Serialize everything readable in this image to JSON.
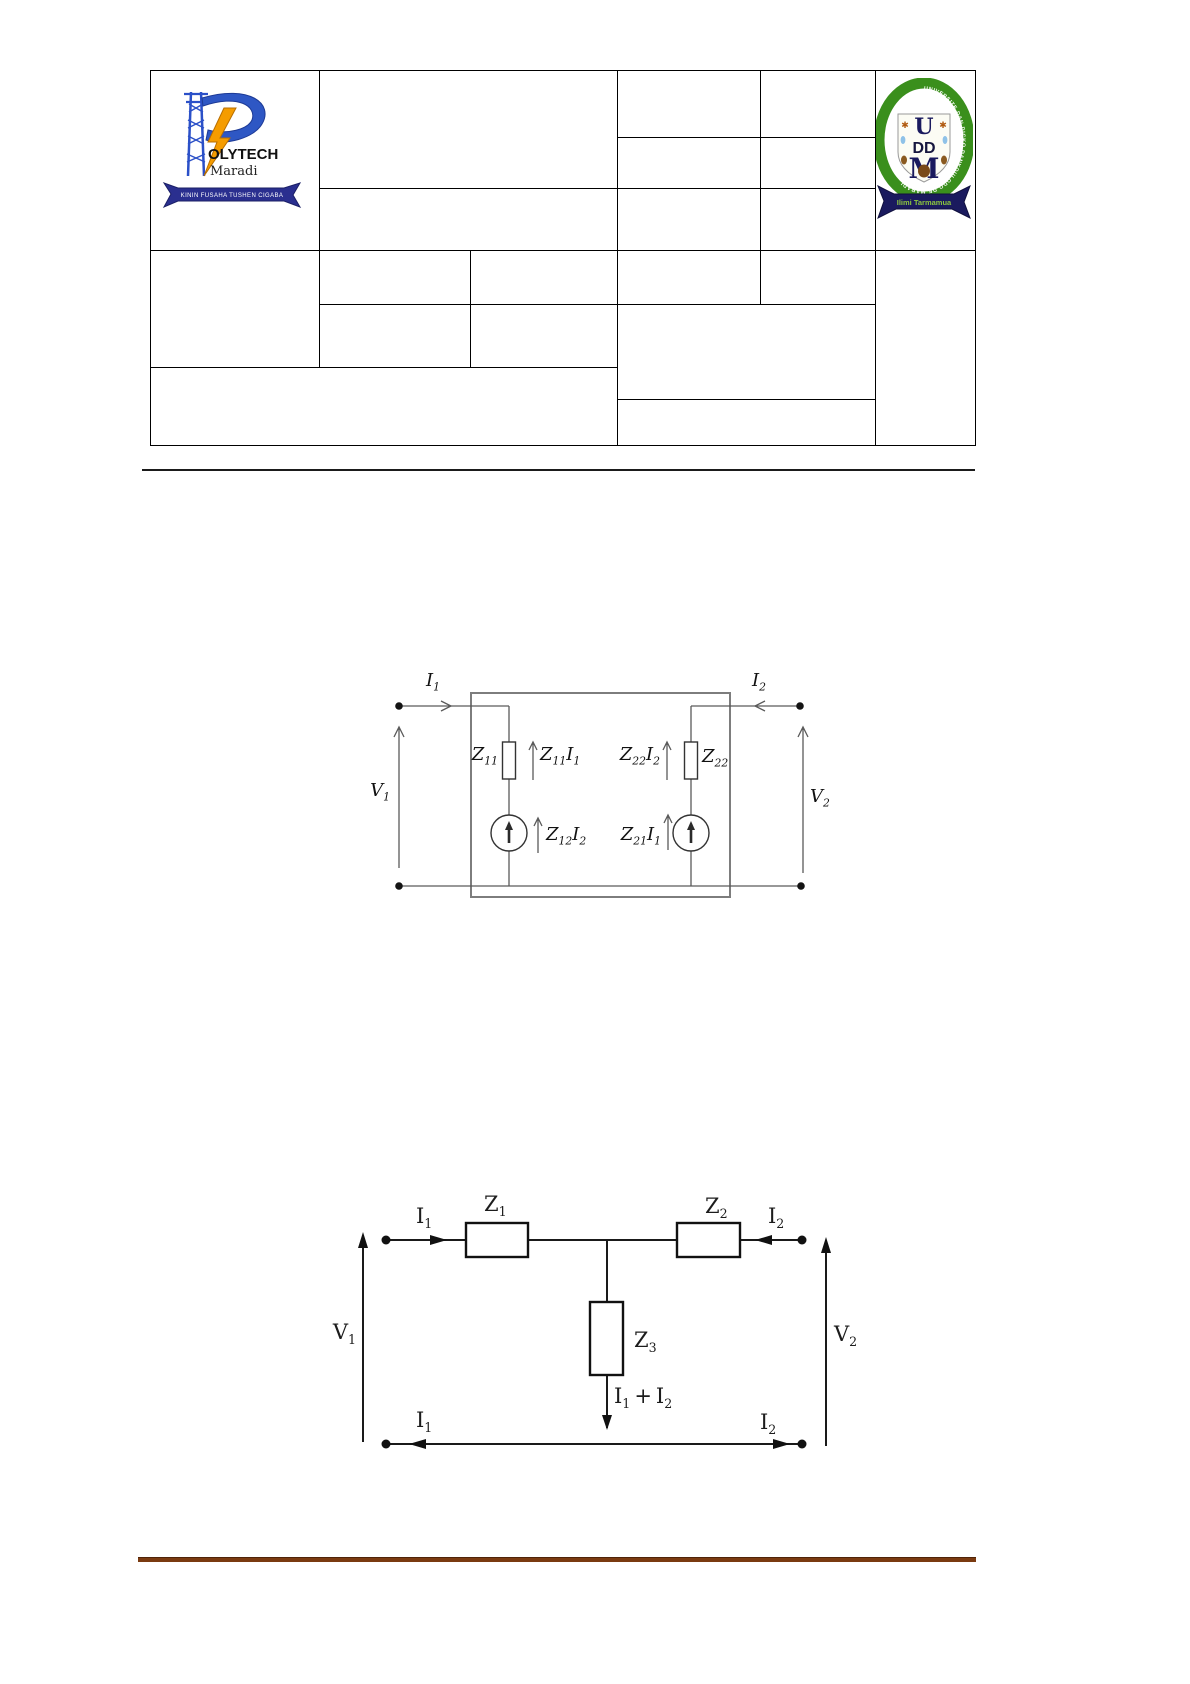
{
  "document": {
    "background": "#ffffff"
  },
  "header": {
    "polytech_logo": {
      "initial": "P",
      "wordmark": "OLYTECH",
      "city": "Maradi",
      "motto": "KININ FUSAHA TUSHEN CIGABA",
      "blue": "#2b50c8",
      "orange": "#f59c00",
      "ribbon_navy": "#2a2f8f"
    },
    "uddm_logo": {
      "ring_text": "UNIVERSITE DAN DICKO DANKOULODO DE MARADI",
      "monogram_u": "U",
      "monogram_dd": "DD",
      "monogram_m": "M",
      "ribbon_text": "Ilimi Tarmamua",
      "green": "#3a8f1c",
      "navy": "#1a1a5e",
      "ribbon_text_color": "#8cc63f"
    }
  },
  "figure1": {
    "i1": {
      "b": "I",
      "s": "1"
    },
    "i2": {
      "b": "I",
      "s": "2"
    },
    "v1": {
      "b": "V",
      "s": "1"
    },
    "v2": {
      "b": "V",
      "s": "2"
    },
    "z11": {
      "b": "Z",
      "s": "11"
    },
    "z22": {
      "b": "Z",
      "s": "22"
    },
    "z11i1": {
      "t1": "Z",
      "s1": "11",
      "t2": "I",
      "s2": "1"
    },
    "z12i2": {
      "t1": "Z",
      "s1": "12",
      "t2": "I",
      "s2": "2"
    },
    "z22i2": {
      "t1": "Z",
      "s1": "22",
      "t2": "I",
      "s2": "2"
    },
    "z21i1": {
      "t1": "Z",
      "s1": "21",
      "t2": "I",
      "s2": "1"
    }
  },
  "figure2": {
    "i1": {
      "b": "I",
      "s": "1"
    },
    "i2": {
      "b": "I",
      "s": "2"
    },
    "v1": {
      "b": "V",
      "s": "1"
    },
    "v2": {
      "b": "V",
      "s": "2"
    },
    "z1": {
      "b": "Z",
      "s": "1"
    },
    "z2": {
      "b": "Z",
      "s": "2"
    },
    "z3": {
      "b": "Z",
      "s": "3"
    },
    "sum": {
      "t1": "I",
      "s1": "1",
      "plus": "+",
      "t2": "I",
      "s2": "2"
    }
  }
}
